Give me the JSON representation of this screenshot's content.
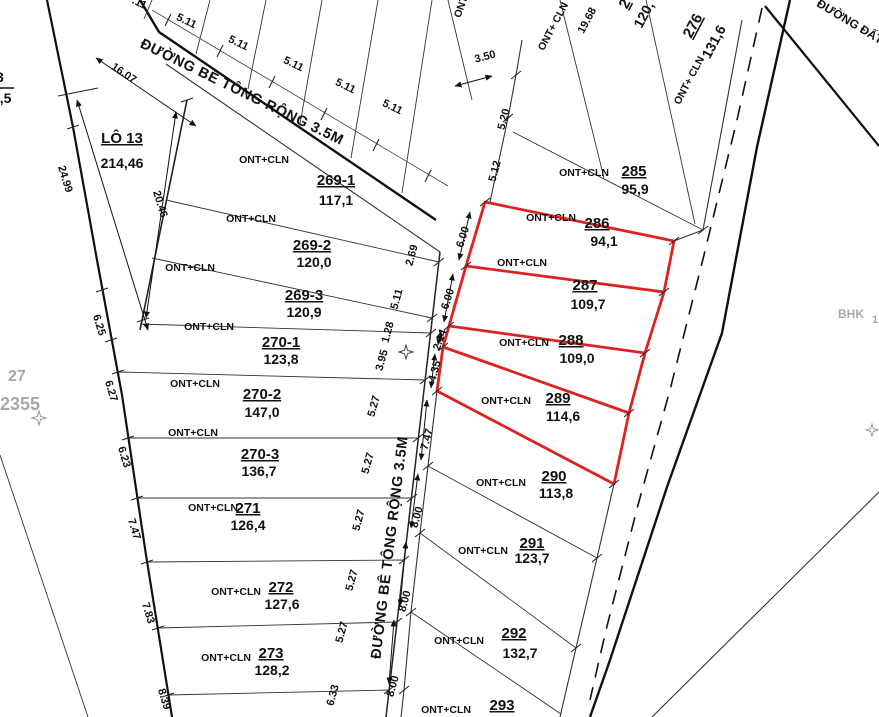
{
  "roads": {
    "top_label": "ĐƯỜNG BÊ TÔNG RỘNG 3.5M",
    "mid_label": "ĐƯỜNG BÊ TÔNG RỘNG 3.5M",
    "dirt_label": "ĐƯỜNG ĐẤT"
  },
  "lot13": {
    "code": "LÔ 13",
    "area": "214,46"
  },
  "left_parcels": [
    {
      "landuse": "ONT+CLN",
      "code": "269-1",
      "area": "117,1"
    },
    {
      "landuse": "ONT+CLN",
      "code": "269-2",
      "area": "120,0"
    },
    {
      "landuse": "ONT+CLN",
      "code": "269-3",
      "area": "120,9"
    },
    {
      "landuse": "ONT+CLN",
      "code": "270-1",
      "area": "123,8"
    },
    {
      "landuse": "ONT+CLN",
      "code": "270-2",
      "area": "147,0"
    },
    {
      "landuse": "ONT+CLN",
      "code": "270-3",
      "area": "136,7"
    },
    {
      "landuse": "ONT+CLN",
      "code": "271",
      "area": "126,4"
    },
    {
      "landuse": "ONT+CLN",
      "code": "272",
      "area": "127,6"
    },
    {
      "landuse": "ONT+CLN",
      "code": "273",
      "area": "128,2"
    }
  ],
  "right_parcels": [
    {
      "landuse": "ONT+CLN",
      "code": "285",
      "area": "95,9",
      "highlighted": false
    },
    {
      "landuse": "ONT+CLN",
      "code": "286",
      "area": "94,1",
      "highlighted": true
    },
    {
      "landuse": "ONT+CLN",
      "code": "287",
      "area": "109,7",
      "highlighted": true
    },
    {
      "landuse": "ONT+CLN",
      "code": "288",
      "area": "109,0",
      "highlighted": true
    },
    {
      "landuse": "ONT+CLN",
      "code": "289",
      "area": "114,6",
      "highlighted": true
    },
    {
      "landuse": "ONT+CLN",
      "code": "290",
      "area": "113,8",
      "highlighted": false
    },
    {
      "landuse": "ONT+CLN",
      "code": "291",
      "area": "123,7",
      "highlighted": false
    },
    {
      "landuse": "ONT+CLN",
      "code": "292",
      "area": "132,7",
      "highlighted": false
    },
    {
      "landuse": "ONT+CLN",
      "code": "293",
      "highlighted": false
    }
  ],
  "parcel_276": {
    "landuse": "ONT+ CLN",
    "code": "276",
    "area": "131,6"
  },
  "strip_labels": {
    "landuse": "ONT+ CLN",
    "dim": "19.68",
    "partial_code": "2",
    "partial_area": "120,",
    "partial_ont": "ONT"
  },
  "edge_partials": {
    "frac_top": "3",
    "frac_bottom": "3,5"
  },
  "annotations": {
    "n27": "27",
    "n2355": "2355",
    "bhk": "BHK",
    "bhk_partial": "1"
  },
  "dims": {
    "top_511": [
      "5.11",
      "5.11",
      "5.11",
      "5.11",
      "5.11"
    ],
    "top_partial": ".11",
    "d_1607": "16.07",
    "d_350": "3.50",
    "d_520": "5.20",
    "d_512": "5.12",
    "left_boundary": [
      "24.99",
      "20.46",
      "6.25",
      "6.27",
      "6.23",
      "7.47",
      "7.83",
      "8.39"
    ],
    "road_west": [
      "2.69",
      "5.11",
      "1.28",
      "3.95",
      "5.27",
      "5.27",
      "5.27",
      "5.27",
      "5.27",
      "6.33"
    ],
    "road_east": [
      "6.00",
      "6.00",
      "2.14",
      "4.35",
      "7.47",
      "8.00",
      "8.00",
      "8.00"
    ]
  },
  "colors": {
    "highlight": "#dd2222",
    "ink": "#111111",
    "muted": "#a8a8a8"
  }
}
